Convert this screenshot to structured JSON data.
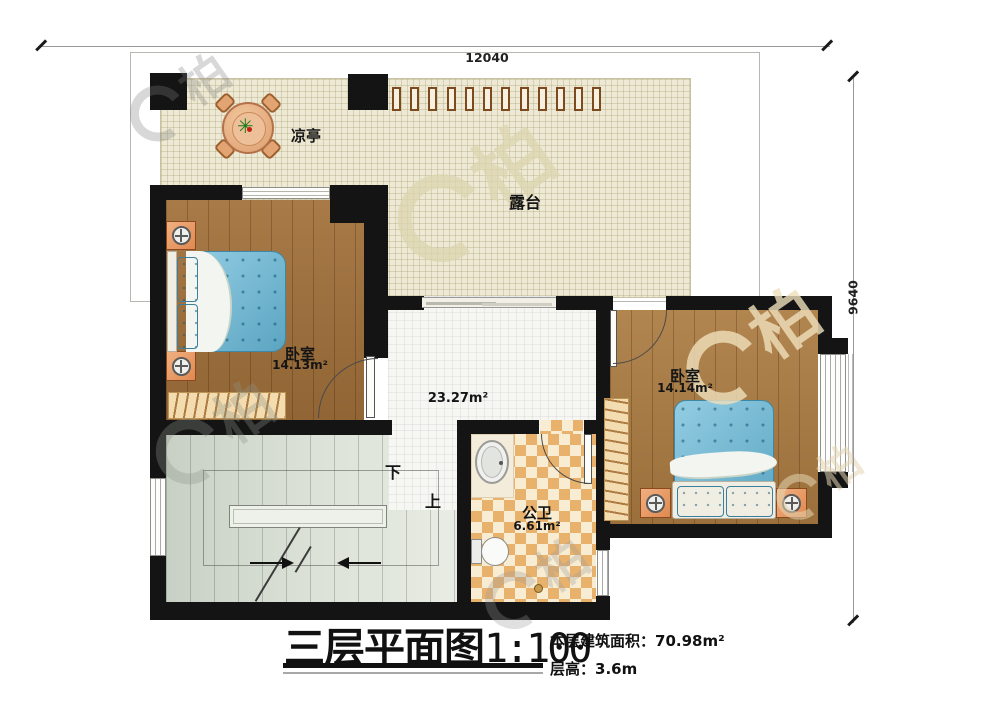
{
  "plan": {
    "title": "三层平面图",
    "scale": "1:100",
    "notes": {
      "area_label": "本层建筑面积：",
      "area_value": "70.98m²",
      "height_label": "层高：",
      "height_value": "3.6m"
    },
    "dimensions": {
      "top_width": "12040",
      "right_height": "9640"
    },
    "rooms": {
      "pavilion": {
        "label": "凉亭"
      },
      "terrace": {
        "label": "露台"
      },
      "bedroom_left": {
        "label": "卧室",
        "area": "14.13m²"
      },
      "bedroom_right": {
        "label": "卧室",
        "area": "14.14m²"
      },
      "hallway": {
        "area": "23.27m²"
      },
      "bathroom": {
        "label": "公卫",
        "area": "6.61m²"
      },
      "stairs": {
        "down_label": "下",
        "up_label": "上"
      }
    },
    "watermark": {
      "char": "柏"
    },
    "colors": {
      "wall": "#141414",
      "terrace_floor": "#ede9d4",
      "tile": "#f6f6f3",
      "wood_left": "#a1703a",
      "wood_right": "#ac7c42",
      "checker_dark": "#e9b26c",
      "checker_light": "#f8ecd2",
      "mattress": "#6fbcd9",
      "pillow": "#66b6d4",
      "blanket": "#f3f5f0",
      "furniture_orange": "#e08850",
      "rug": "#f3ddb0",
      "dim_line": "#999999"
    }
  }
}
